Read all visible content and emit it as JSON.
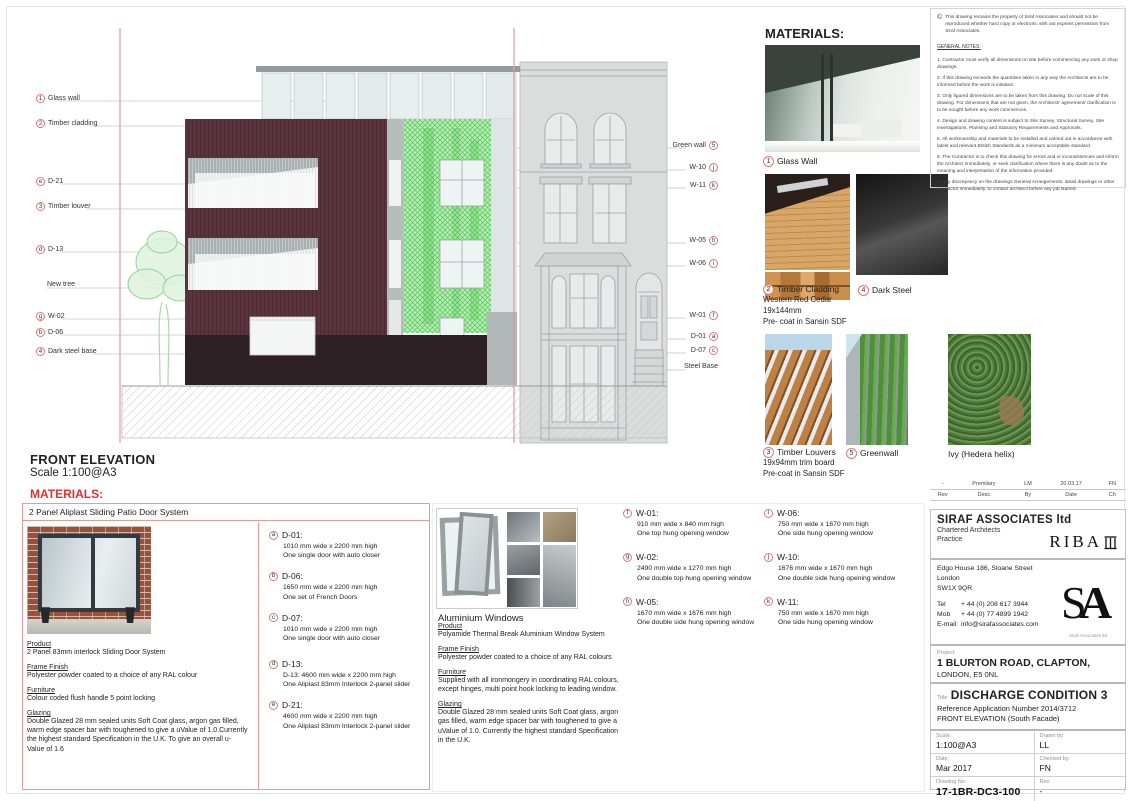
{
  "sheet": {
    "front_elevation_title": "FRONT ELEVATION",
    "front_elevation_scale": "Scale 1:100@A3",
    "materials_heading_left": "MATERIALS:"
  },
  "elevation_labels": {
    "left": [
      {
        "mark": "1",
        "text": "Glass wall"
      },
      {
        "mark": "2",
        "text": "Timber cladding"
      },
      {
        "mark": "e",
        "text": "D-21"
      },
      {
        "mark": "3",
        "text": "Timber louver"
      },
      {
        "mark": "d",
        "text": "D-13"
      },
      {
        "mark": "",
        "text": "New tree"
      },
      {
        "mark": "g",
        "text": "W-02"
      },
      {
        "mark": "b",
        "text": "D-06"
      },
      {
        "mark": "4",
        "text": "Dark steel base"
      }
    ],
    "right": [
      {
        "text": "Green wall",
        "mark": "5"
      },
      {
        "text": "W-10",
        "mark": "j"
      },
      {
        "text": "W-11",
        "mark": "k"
      },
      {
        "text": "W-05",
        "mark": "h"
      },
      {
        "text": "W-06",
        "mark": "i"
      },
      {
        "text": "W-01",
        "mark": "f"
      },
      {
        "text": "D-01",
        "mark": "a"
      },
      {
        "text": "D-07",
        "mark": "c"
      },
      {
        "text": "Steel Base",
        "mark": ""
      }
    ]
  },
  "notes_panel": {
    "copyright_symbol": "©",
    "copyright": "This drawing remains the property of Siraf Associates and should not be reproduced whether hard copy or electronic with out express permission from Siraf Associates.",
    "heading": "GENERAL NOTES:",
    "notes": [
      "1. Contractor must verify all dimensions on site before commencing any work or shop drawings.",
      "2. If this drawing exceeds the quantities taken in any way the Architects are to be informed before the work is initiated.",
      "3. Only figured dimensions are to be taken from this drawing. Do not scale of this drawing.  For dimensions that are not given, the Architects' agreement/ clarification is to be sought before any work commences.",
      "4. Design and drawing content is subject to Site Survey, Structural Survey, Site Investigations, Planning and Statutory Requirements and Approvals.",
      "5. All workmanship and materials to be installed and carried out in accordance with latest and relevant British Standards as a minimum acceptable standard.",
      "6. The Contractor is to check this drawing for errors and or inconsistencies and inform the Architect immediately, or seek clarification where there is any doubt as to the meaning and interpretation of the information provided.",
      "7. Any discrepancy on the drawings General Arrangements, detail drawings or other contractor immediately, to contact architect before any job started."
    ]
  },
  "materials_panel": {
    "heading": "MATERIALS:",
    "glass_wall": {
      "mark": "1",
      "label": "Glass Wall"
    },
    "timber_cladding": {
      "mark": "2",
      "label": "Timber Cladding",
      "line2": "Western Red Cedar",
      "line3": "19x144mm",
      "line4": "Pre- coat in Sansin SDF"
    },
    "dark_steel": {
      "mark": "4",
      "label": "Dark Steel"
    },
    "timber_louvers": {
      "mark": "3",
      "label": "Timber Louvers",
      "line2": "19x94mm trim board",
      "line3": "Pre-coat in Sansin SDF"
    },
    "greenwall": {
      "mark": "5",
      "label": "Greenwall"
    },
    "ivy": {
      "label": "Ivy (Hedera helix)"
    }
  },
  "door_spec": {
    "header": "2 Panel Aliplast Sliding Patio Door System",
    "product_label": "Product",
    "product": "2 Panel 83mm interlock  Sliding Door System",
    "frame_label": "Frame Finish",
    "frame": "Polyester powder coated to a choice of any RAL colour",
    "furniture_label": "Furniture",
    "furniture": "Colour coded flush handle 5 point locking",
    "glazing_label": "Glazing",
    "glazing": "Double Glazed  28 mm sealed units Soft Coat glass, argon gas filled, warm edge spacer bar with toughened to give a uValue of 1.0.Currently the highest standard Specification in the U.K. To give an overall u-Value of 1.6"
  },
  "door_schedule": [
    {
      "mark": "a",
      "code": "D-01:",
      "dim": "1010 mm wide x 2200 mm high",
      "desc": "One single door with auto closer"
    },
    {
      "mark": "b",
      "code": "D-06:",
      "dim": "1650 mm wide x 2200 mm high",
      "desc": "One set of French Doors"
    },
    {
      "mark": "c",
      "code": "D-07:",
      "dim": "1010 mm wide x 2200 mm high",
      "desc": "One single door with auto closer"
    },
    {
      "mark": "d",
      "code": "D-13:",
      "dim": "D-13: 4600 mm wide x 2200 mm high",
      "desc": "One Aliplast 83mm Interlock 2-panel slider"
    },
    {
      "mark": "e",
      "code": "D-21:",
      "dim": "4600 mm wide x 2200 mm high",
      "desc": "One Aliplast 83mm Interlock 2-panel slider"
    }
  ],
  "window_spec": {
    "title": "Aluminium Windows",
    "product_label": "Product",
    "product": "Polyamide Thermal Break Aluminium Window System",
    "frame_label": "Frame Finish",
    "frame": "Polyester powder coated to a choice of any RAL colours",
    "furniture_label": "Furniture",
    "furniture": "Supplied with all ironmongery in coordinating RAL colours, except hinges, multi point hook locking to leading window.",
    "glazing_label": "Glazing",
    "glazing": "Double Glazed  28 mm sealed units Soft Coat glass, argon gas filled, warm edge spacer bar with toughened to give a uValue of 1.0. Currently the highest standard Specification in the U.K."
  },
  "window_schedule": [
    {
      "mark": "f",
      "code": "W-01:",
      "dim": "910 mm wide x 840 mm high",
      "desc": "One top hung opening window"
    },
    {
      "mark": "g",
      "code": "W-02:",
      "dim": "2490 mm wide x 1270 mm high",
      "desc": "One double top hung opening window"
    },
    {
      "mark": "h",
      "code": "W-05:",
      "dim": "1670 mm wide x 1676 mm high",
      "desc": "One double side hung opening window"
    },
    {
      "mark": "i",
      "code": "W-06:",
      "dim": "750 mm wide x 1670 mm high",
      "desc": "One side hung opening window"
    },
    {
      "mark": "j",
      "code": "W-10:",
      "dim": "1676 mm wide x 1670 mm high",
      "desc": "One double side hung opening window"
    },
    {
      "mark": "k",
      "code": "W-11:",
      "dim": "750 mm wide x 1670 mm high",
      "desc": "One side hung opening window"
    }
  ],
  "revision": {
    "rev": "-",
    "desc": "Premilary",
    "by": "LM",
    "date": "20.03.17",
    "ch": "FN",
    "h_rev": "Rev",
    "h_desc": "Desc",
    "h_by": "By",
    "h_date": "Date",
    "h_ch": "Ch"
  },
  "title_block": {
    "firm": "SIRAF ASSOCIATES ltd",
    "firm_sub1": "Chartered Architects",
    "firm_sub2": "Practice",
    "riba": "RIBA",
    "address1": "Edgo House 186, Sloane Street",
    "address2": "London",
    "address3": "SW1X 9QR",
    "tel_label": "Tel",
    "tel": "+ 44 (0) 208 617 3944",
    "mob_label": "Mob",
    "mob": "+ 44 (0) 77 4899 1942",
    "email_label": "E-mail:",
    "email": "info@sirafassociates.com",
    "sa_s": "S",
    "sa_a": "A",
    "sa_caption": "Siraf Associates ltd",
    "project_label": "Project:",
    "project1": "1 BLURTON ROAD, CLAPTON,",
    "project2": "LONDON,  E5 0NL",
    "title_label": "Title:",
    "title": "DISCHARGE CONDITION 3",
    "title_ref": "Reference Application Number 2014/3712",
    "title_sub": "FRONT ELEVATION (South Facade)",
    "scale_label": "Scale:",
    "scale": "1:100@A3",
    "drawn_label": "Drawn  by:",
    "drawn": "LL",
    "date_label": "Date:",
    "date": "Mar 2017",
    "checked_label": "Checked  by:",
    "checked": "FN",
    "drawing_no_label": "Drawing  No:",
    "drawing_no": "17-1BR-DC3-100",
    "rev_label": "Rev:",
    "rev": "-"
  },
  "colors": {
    "cladding_maroon": "#5a333c",
    "dark_base": "#2e2126",
    "greenwall": "#55c855",
    "red_accent": "#e03030",
    "boundary_line": "#e89898"
  }
}
